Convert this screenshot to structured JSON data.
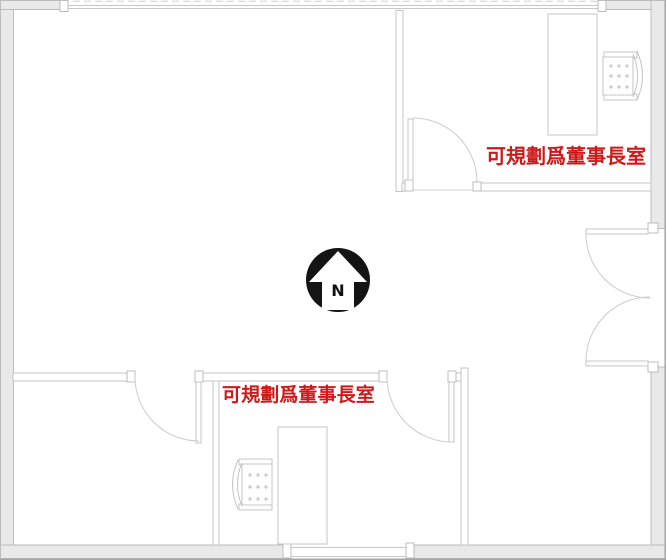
{
  "labels": {
    "top_right_room_note": "可規劃爲董事長室",
    "bottom_room_note": "可規劃爲董事長室"
  },
  "compass": {
    "north_letter": "N"
  },
  "colors": {
    "annotation_red": "#cd1b1b",
    "compass_black": "#141414",
    "wall_fill": "#e9e9e9",
    "wall_stroke": "#bcbcbc",
    "thin_line_gray": "#c8c8c8",
    "background": "#ffffff"
  },
  "icons": {
    "compass": "north-arrow-compass-icon",
    "chairs": "office-chair-icon",
    "desks": "desk-symbol",
    "doors": "door-swing-symbol"
  }
}
